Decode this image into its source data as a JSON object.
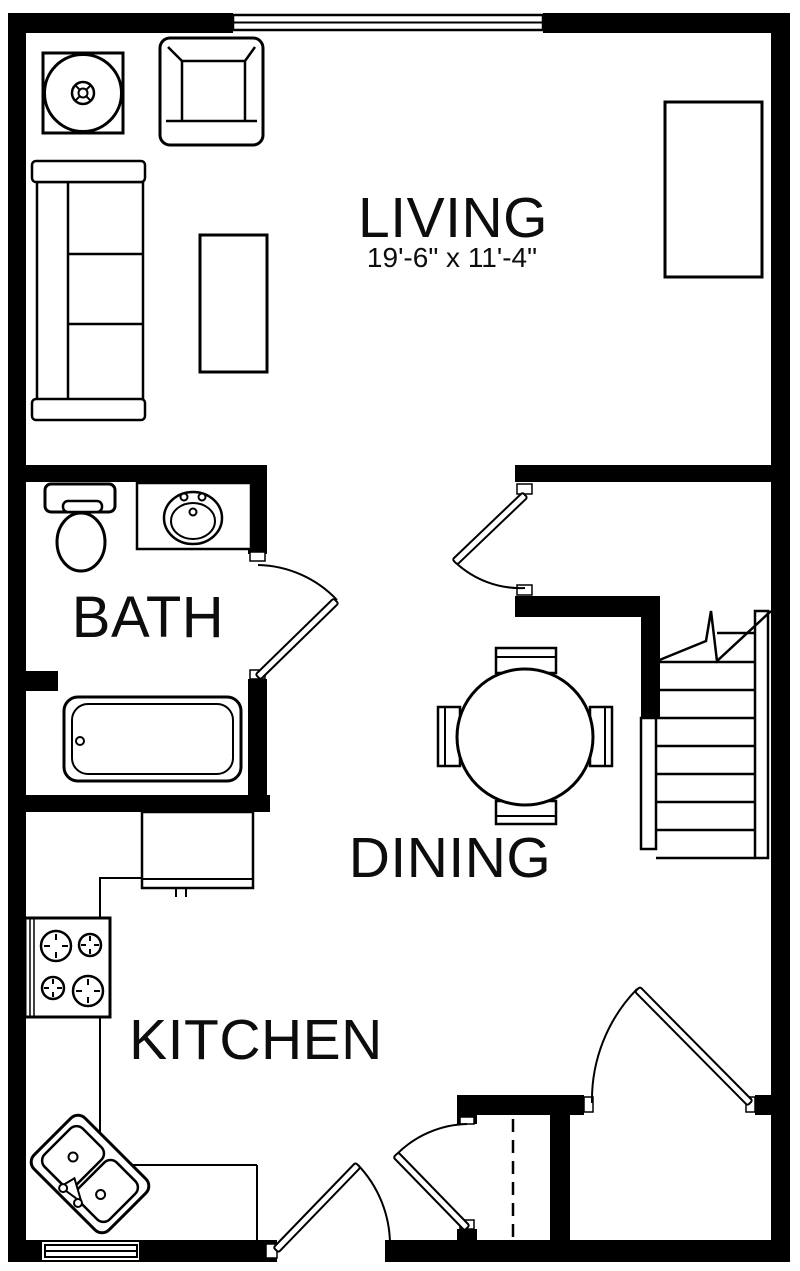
{
  "plan": {
    "colors": {
      "line": "#000000",
      "background": "#ffffff",
      "text": "#0d0d0d"
    },
    "rooms": {
      "living": {
        "label": "LIVING",
        "dimensions": "19'-6\" x 11'-4\""
      },
      "bath": {
        "label": "BATH"
      },
      "dining": {
        "label": "DINING"
      },
      "kitchen": {
        "label": "KITCHEN"
      }
    },
    "fixtures": [
      "round-side-table",
      "armchair",
      "sofa",
      "coffee-table",
      "tv-cabinet",
      "toilet",
      "bathroom-sink",
      "bathtub",
      "dining-table",
      "dining-chairs",
      "pantry-cabinet",
      "stove",
      "kitchen-corner-sink",
      "staircase",
      "closet",
      "bath-door",
      "living-dining-door",
      "entry-door",
      "front-door",
      "closet-door",
      "window-top",
      "window-bottom"
    ]
  }
}
